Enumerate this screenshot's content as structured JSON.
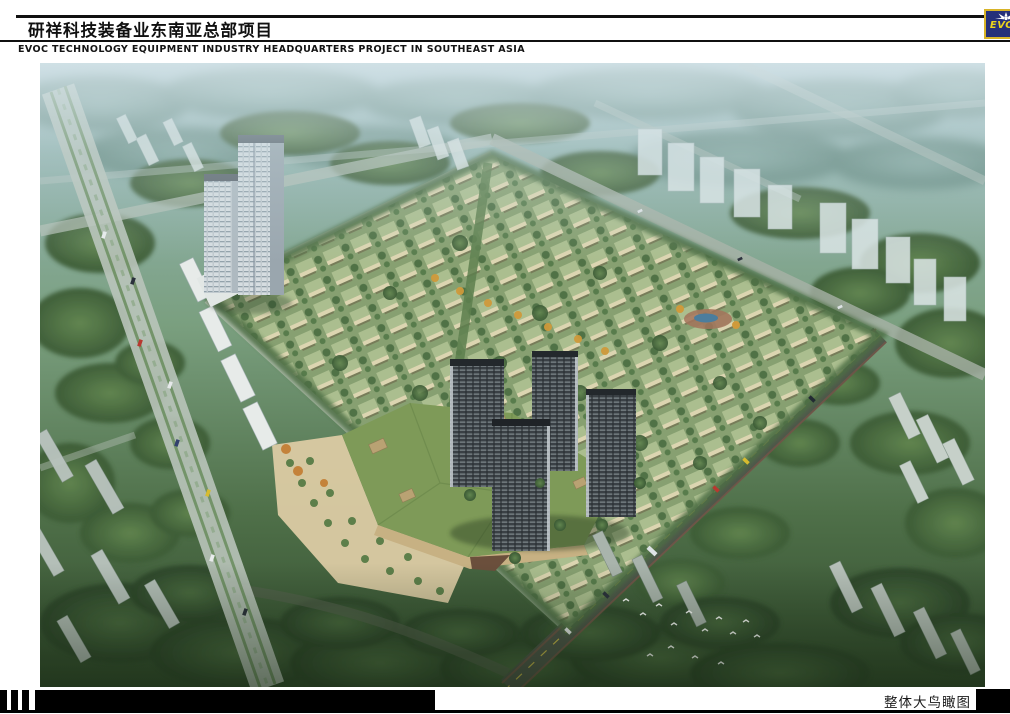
{
  "header": {
    "title": "研祥科技装备业东南亚总部项目",
    "subtitle": "EVOC TECHNOLOGY EQUIPMENT INDUSTRY HEADQUARTERS PROJECT IN SOUTHEAST ASIA"
  },
  "logo": {
    "text": "EVOC",
    "colors": {
      "background": "#25307a",
      "border": "#d8b428",
      "text": "#ead41c",
      "star": "#ffffff"
    }
  },
  "footer": {
    "caption": "整体大鸟瞰图"
  },
  "colors": {
    "rule": "#101010",
    "footer_bars": "#000000",
    "sky_haze": "#cfe0e6",
    "forest_green": "#3f5d3a",
    "villa_roof": "#adbf90",
    "plaza_sand": "#d9c9a2"
  }
}
